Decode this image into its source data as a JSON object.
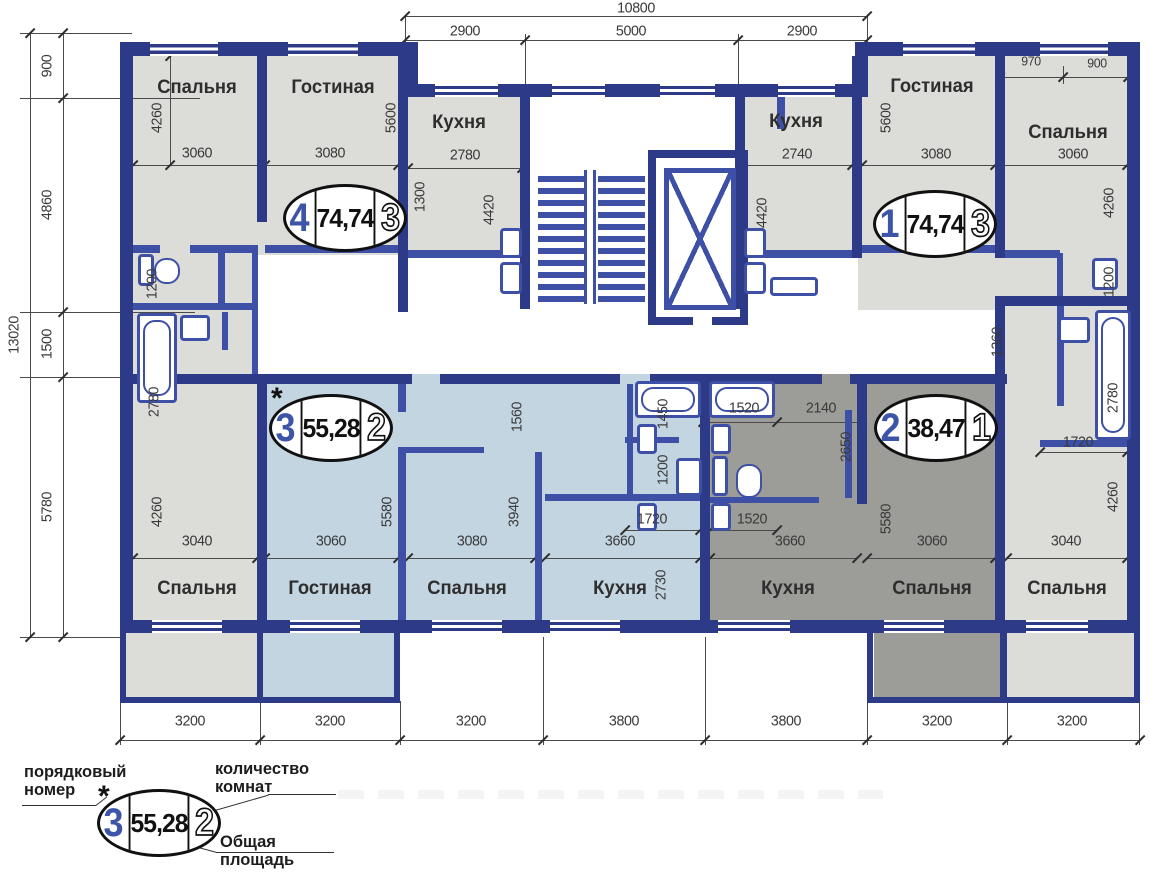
{
  "colors": {
    "wall": "#2c3a87",
    "partition": "#3e50a6",
    "room_gray": "#dcdcd9",
    "apartment_blue": "#c3d5e1",
    "apartment_dark": "#9c9c98",
    "number_blue": "#3d55a8",
    "dim_text": "#3a3a3a"
  },
  "apartments": [
    {
      "number": "4",
      "area": "74,74",
      "rooms": "3",
      "cx": 345,
      "cy": 218,
      "star": false
    },
    {
      "number": "1",
      "area": "74,74",
      "rooms": "3",
      "cx": 935,
      "cy": 224,
      "star": false
    },
    {
      "number": "3",
      "area": "55,28",
      "rooms": "2",
      "cx": 331,
      "cy": 428,
      "star": true
    },
    {
      "number": "2",
      "area": "38,47",
      "rooms": "1",
      "cx": 936,
      "cy": 428,
      "star": false
    }
  ],
  "room_labels": [
    {
      "label": "Спальня",
      "x": 197,
      "y": 88
    },
    {
      "label": "Гостиная",
      "x": 333,
      "y": 88
    },
    {
      "label": "Кухня",
      "x": 459,
      "y": 123
    },
    {
      "label": "Кухня",
      "x": 796,
      "y": 122
    },
    {
      "label": "Гостиная",
      "x": 932,
      "y": 87
    },
    {
      "label": "Спальня",
      "x": 1068,
      "y": 133
    },
    {
      "label": "Спальня",
      "x": 197,
      "y": 589
    },
    {
      "label": "Гостиная",
      "x": 330,
      "y": 589
    },
    {
      "label": "Спальня",
      "x": 467,
      "y": 589
    },
    {
      "label": "Кухня",
      "x": 620,
      "y": 589
    },
    {
      "label": "Кухня",
      "x": 788,
      "y": 589
    },
    {
      "label": "Спальня",
      "x": 932,
      "y": 589
    },
    {
      "label": "Спальня",
      "x": 1067,
      "y": 589
    }
  ],
  "dims": [
    {
      "t": "10800",
      "x": 636,
      "y": 8
    },
    {
      "t": "2900",
      "x": 465,
      "y": 31
    },
    {
      "t": "5000",
      "x": 631,
      "y": 31
    },
    {
      "t": "2900",
      "x": 802,
      "y": 31
    },
    {
      "t": "970",
      "x": 1031,
      "y": 61,
      "s": 13
    },
    {
      "t": "900",
      "x": 1097,
      "y": 63,
      "s": 13
    },
    {
      "t": "13020",
      "x": 14,
      "y": 335,
      "v": 1
    },
    {
      "t": "900",
      "x": 47,
      "y": 66,
      "v": 1
    },
    {
      "t": "4860",
      "x": 47,
      "y": 205,
      "v": 1
    },
    {
      "t": "1500",
      "x": 47,
      "y": 344,
      "v": 1
    },
    {
      "t": "5780",
      "x": 47,
      "y": 507,
      "v": 1
    },
    {
      "t": "4260",
      "x": 157,
      "y": 118,
      "v": 1
    },
    {
      "t": "3060",
      "x": 197,
      "y": 153
    },
    {
      "t": "3080",
      "x": 330,
      "y": 153
    },
    {
      "t": "5600",
      "x": 391,
      "y": 118,
      "v": 1
    },
    {
      "t": "2780",
      "x": 465,
      "y": 155
    },
    {
      "t": "1300",
      "x": 420,
      "y": 197,
      "v": 1
    },
    {
      "t": "4420",
      "x": 489,
      "y": 210,
      "v": 1
    },
    {
      "t": "1200",
      "x": 152,
      "y": 284,
      "v": 1
    },
    {
      "t": "2780",
      "x": 154,
      "y": 402,
      "v": 1
    },
    {
      "t": "4260",
      "x": 157,
      "y": 512,
      "v": 1
    },
    {
      "t": "3040",
      "x": 197,
      "y": 541
    },
    {
      "t": "1560",
      "x": 517,
      "y": 417,
      "v": 1
    },
    {
      "t": "5580",
      "x": 387,
      "y": 512,
      "v": 1
    },
    {
      "t": "3940",
      "x": 514,
      "y": 512,
      "v": 1
    },
    {
      "t": "3060",
      "x": 331,
      "y": 541
    },
    {
      "t": "3080",
      "x": 472,
      "y": 541
    },
    {
      "t": "3660",
      "x": 620,
      "y": 541
    },
    {
      "t": "2730",
      "x": 661,
      "y": 585,
      "v": 1
    },
    {
      "t": "1450",
      "x": 663,
      "y": 414,
      "v": 1
    },
    {
      "t": "1200",
      "x": 663,
      "y": 470,
      "v": 1
    },
    {
      "t": "1720",
      "x": 652,
      "y": 519
    },
    {
      "t": "1520",
      "x": 752,
      "y": 519
    },
    {
      "t": "1520",
      "x": 744,
      "y": 408
    },
    {
      "t": "2140",
      "x": 821,
      "y": 408
    },
    {
      "t": "2650",
      "x": 846,
      "y": 447,
      "v": 1
    },
    {
      "t": "5580",
      "x": 886,
      "y": 519,
      "v": 1
    },
    {
      "t": "3660",
      "x": 790,
      "y": 541
    },
    {
      "t": "3060",
      "x": 932,
      "y": 541
    },
    {
      "t": "1360",
      "x": 997,
      "y": 342,
      "v": 1
    },
    {
      "t": "2780",
      "x": 1113,
      "y": 398,
      "v": 1
    },
    {
      "t": "1720",
      "x": 1078,
      "y": 442
    },
    {
      "t": "4260",
      "x": 1113,
      "y": 497,
      "v": 1
    },
    {
      "t": "3040",
      "x": 1066,
      "y": 541
    },
    {
      "t": "4420",
      "x": 762,
      "y": 213,
      "v": 1
    },
    {
      "t": "2740",
      "x": 797,
      "y": 154
    },
    {
      "t": "5600",
      "x": 886,
      "y": 118,
      "v": 1
    },
    {
      "t": "3080",
      "x": 936,
      "y": 154
    },
    {
      "t": "3060",
      "x": 1073,
      "y": 154
    },
    {
      "t": "4260",
      "x": 1109,
      "y": 203,
      "v": 1
    },
    {
      "t": "1200",
      "x": 1109,
      "y": 282,
      "v": 1
    },
    {
      "t": "3200",
      "x": 190,
      "y": 721
    },
    {
      "t": "3200",
      "x": 330,
      "y": 721
    },
    {
      "t": "3200",
      "x": 471,
      "y": 721
    },
    {
      "t": "3800",
      "x": 624,
      "y": 721
    },
    {
      "t": "3800",
      "x": 786,
      "y": 721
    },
    {
      "t": "3200",
      "x": 937,
      "y": 721
    },
    {
      "t": "3200",
      "x": 1072,
      "y": 721
    }
  ],
  "legend": {
    "serial_label": "порядковый номер",
    "rooms_label": "количество комнат",
    "area_label": "Общая площадь",
    "star": "*",
    "example": {
      "number": "3",
      "area": "55,28",
      "rooms": "2"
    }
  }
}
